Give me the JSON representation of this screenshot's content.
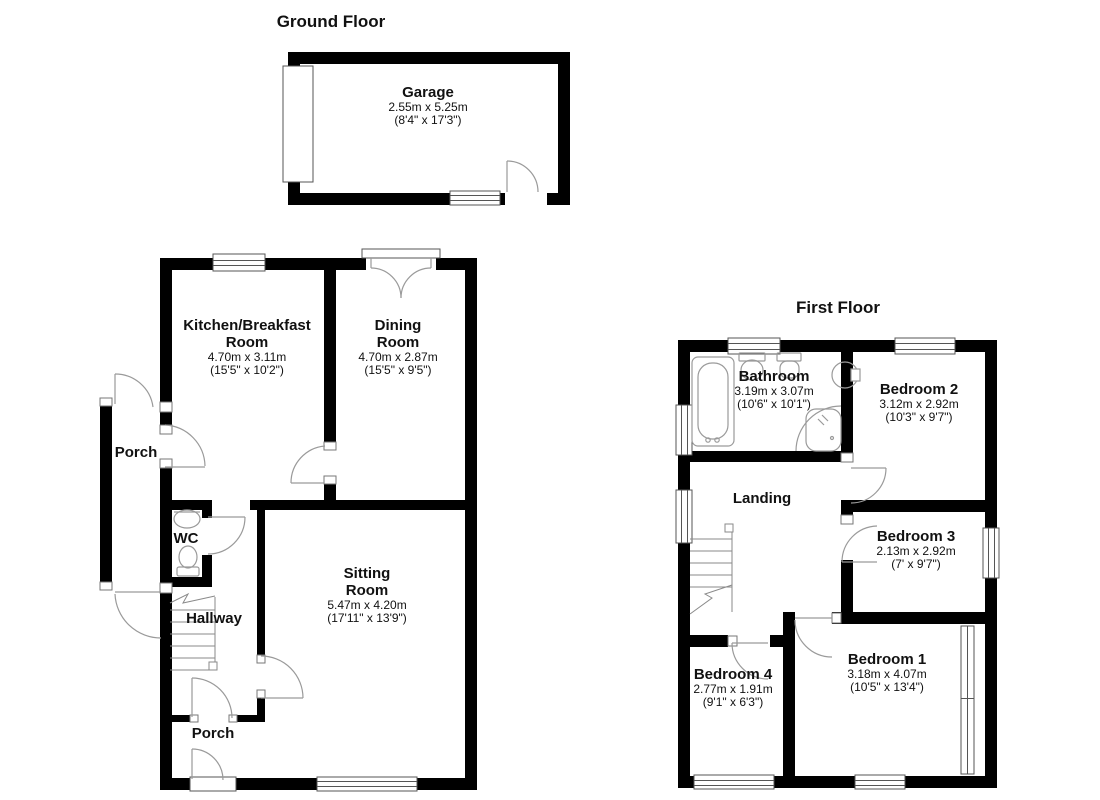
{
  "titles": {
    "ground_floor": "Ground Floor",
    "first_floor": "First Floor"
  },
  "rooms": {
    "garage": {
      "name": "Garage",
      "metric": "2.55m x 5.25m",
      "imperial": "(8'4\" x 17'3\")"
    },
    "kitchen": {
      "name1": "Kitchen/Breakfast",
      "name2": "Room",
      "metric": "4.70m x 3.11m",
      "imperial": "(15'5\" x 10'2\")"
    },
    "dining": {
      "name1": "Dining",
      "name2": "Room",
      "metric": "4.70m x 2.87m",
      "imperial": "(15'5\" x 9'5\")"
    },
    "porch_side": {
      "name": "Porch"
    },
    "wc": {
      "name": "WC"
    },
    "hallway": {
      "name": "Hallway"
    },
    "sitting": {
      "name1": "Sitting",
      "name2": "Room",
      "metric": "5.47m x 4.20m",
      "imperial": "(17'11\" x 13'9\")"
    },
    "porch_bottom": {
      "name": "Porch"
    },
    "bathroom": {
      "name": "Bathroom",
      "metric": "3.19m x 3.07m",
      "imperial": "(10'6\" x 10'1\")"
    },
    "bedroom2": {
      "name": "Bedroom 2",
      "metric": "3.12m x 2.92m",
      "imperial": "(10'3\" x 9'7\")"
    },
    "landing": {
      "name": "Landing"
    },
    "bedroom3": {
      "name": "Bedroom 3",
      "metric": "2.13m x 2.92m",
      "imperial": "(7' x 9'7\")"
    },
    "bedroom4": {
      "name": "Bedroom 4",
      "metric": "2.77m x 1.91m",
      "imperial": "(9'1\" x 6'3\")"
    },
    "bedroom1": {
      "name": "Bedroom 1",
      "metric": "3.18m x 4.07m",
      "imperial": "(10'5\" x 13'4\")"
    }
  },
  "colors": {
    "wall": "#000000",
    "floor": "#ffffff",
    "door_line": "#9a9a9a",
    "window_frame": "#555555",
    "text": "#111111"
  }
}
